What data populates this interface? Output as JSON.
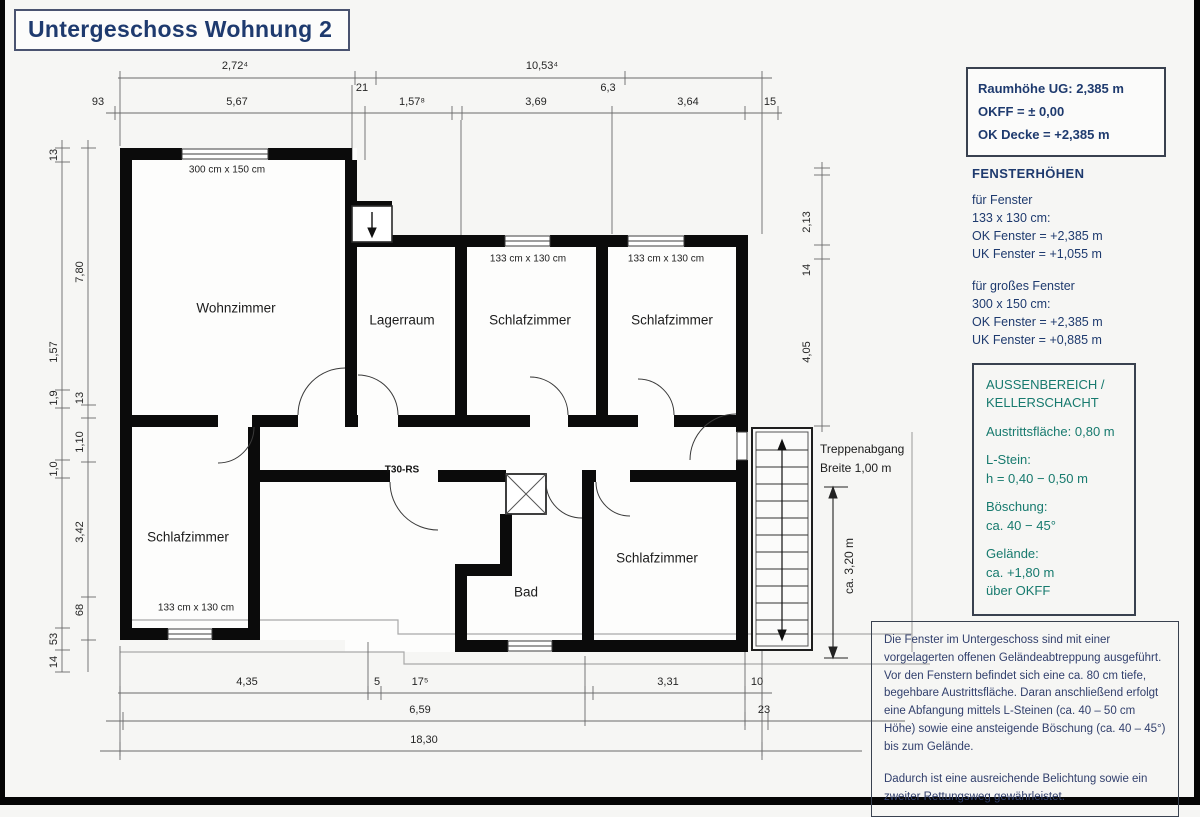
{
  "colors": {
    "navy": "#1e3a6e",
    "teal": "#177a6e"
  },
  "title": "Untergeschoss Wohnung 2",
  "info_box": {
    "line1": "Raumhöhe UG: 2,385 m",
    "line2": "OKFF = ± 0,00",
    "line3": "OK Decke = +2,385 m"
  },
  "fenster_block": {
    "heading": "FENSTERHÖHEN",
    "g1l1": "für Fenster",
    "g1l2": "133 x 130 cm:",
    "g1l3": "OK Fenster = +2,385 m",
    "g1l4": "UK Fenster = +1,055 m",
    "g2l1": "für großes Fenster",
    "g2l2": "300 x 150 cm:",
    "g2l3": "OK Fenster = +2,385 m",
    "g2l4": "UK Fenster = +0,885 m"
  },
  "aussen_box": {
    "heading1": "AUSSENBEREICH /",
    "heading2": "KELLERSCHACHT",
    "austritt": "Austrittsfläche: 0,80 m",
    "lstein1": "L-Stein:",
    "lstein2": "h = 0,40 − 0,50 m",
    "boeschung1": "Böschung:",
    "boeschung2": "ca. 40 − 45°",
    "gelaende1": "Gelände:",
    "gelaende2": "ca. +1,80 m",
    "gelaende3": "über OKFF"
  },
  "note_box": {
    "para1": "Die Fenster im Untergeschoss sind mit einer vorgelagerten offenen Geländeabtreppung ausgeführt.  Vor den Fenstern befindet sich eine ca. 80 cm tiefe, begehbare Austrittsfläche. Daran anschließend erfolgt eine Abfangung mittels L-Steinen (ca. 40 – 50 cm Höhe) sowie eine ansteigende Böschung (ca. 40 – 45°) bis zum Gelände.",
    "para2": "Dadurch ist eine ausreichende Belichtung sowie ein zweiter Rettungsweg gewährleistet."
  },
  "rooms": {
    "wohnzimmer": "Wohnzimmer",
    "lagerraum": "Lagerraum",
    "schlafzimmer_top_mid": "Schlafzimmer",
    "schlafzimmer_top_right": "Schlafzimmer",
    "schlafzimmer_sw": "Schlafzimmer",
    "bad": "Bad",
    "schlafzimmer_se": "Schlafzimmer"
  },
  "windows": {
    "big": "300 cm x 150 cm",
    "w1": "133 cm x 130 cm",
    "w2": "133 cm x 130 cm",
    "w3": "133 cm x 130 cm"
  },
  "doors": {
    "fire_door": "T30-RS"
  },
  "stairs": {
    "label1": "Treppenabgang",
    "label2": "Breite 1,00 m",
    "dim": "ca. 3,20 m"
  },
  "dims": {
    "t1a": "2,72⁴",
    "t1b": "21",
    "t1c": "10,53⁴",
    "t1d": "6,3",
    "t2a": "93",
    "t2b": "5,67",
    "t2c": "1,57⁸",
    "t2d": "3,69",
    "t2e": "3,64",
    "t2f": "15",
    "lo1": "13",
    "lo2": "1,57",
    "lo3": "1,9",
    "lo4": "1,0",
    "lo5": "53",
    "lo6": "14",
    "li1": "7,80",
    "li2": "13",
    "li3": "1,10",
    "li4": "3,42",
    "li5": "68",
    "r1": "2,13",
    "r2": "14",
    "r3": "4,05",
    "b1a": "4,35",
    "b1b": "5",
    "b1c": "17⁵",
    "b1d": "3,31",
    "b1e": "10",
    "b2a": "6,59",
    "b2b": "23",
    "b3a": "18,30"
  }
}
